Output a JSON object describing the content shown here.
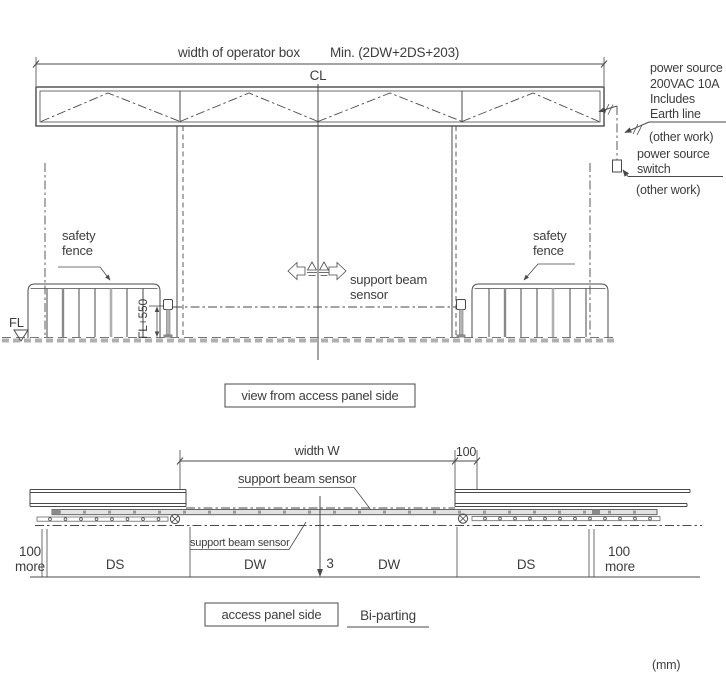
{
  "colors": {
    "line": "#4a4a4a",
    "text": "#3d3d3d",
    "light_gray": "#b0b0b0",
    "mid_gray": "#8a8a8a",
    "background": "#ffffff"
  },
  "elevation": {
    "dim_label": "width of operator box",
    "dim_min": "Min. (2DW+2DS+203)",
    "centerline": "CL",
    "power_block": {
      "l1": "power source",
      "l2": "200VAC 10A",
      "l3": "Includes",
      "l4": "Earth line"
    },
    "other_work_upper": "(other work)",
    "switch_block": {
      "l1": "power source",
      "l2": "switch"
    },
    "other_work_lower": "(other work)",
    "fence_left": {
      "l1": "safety",
      "l2": "fence"
    },
    "fence_right": {
      "l1": "safety",
      "l2": "fence"
    },
    "floor": "FL",
    "beam_height": "FL+550",
    "beam_sensor": {
      "l1": "support beam",
      "l2": "sensor"
    },
    "caption": "view from access panel side"
  },
  "plan": {
    "dim_width": "width W",
    "dim_100": "100",
    "beam_sensor_upper": "support beam sensor",
    "beam_sensor_lower": "support beam sensor",
    "margin_left": {
      "l1": "100",
      "l2": "more"
    },
    "ds_left": "DS",
    "dw_left": "DW",
    "gap": "3",
    "dw_right": "DW",
    "ds_right": "DS",
    "margin_right": {
      "l1": "100",
      "l2": "more"
    },
    "caption": "access panel side",
    "door_type": "Bi-parting"
  },
  "units": "(mm)"
}
